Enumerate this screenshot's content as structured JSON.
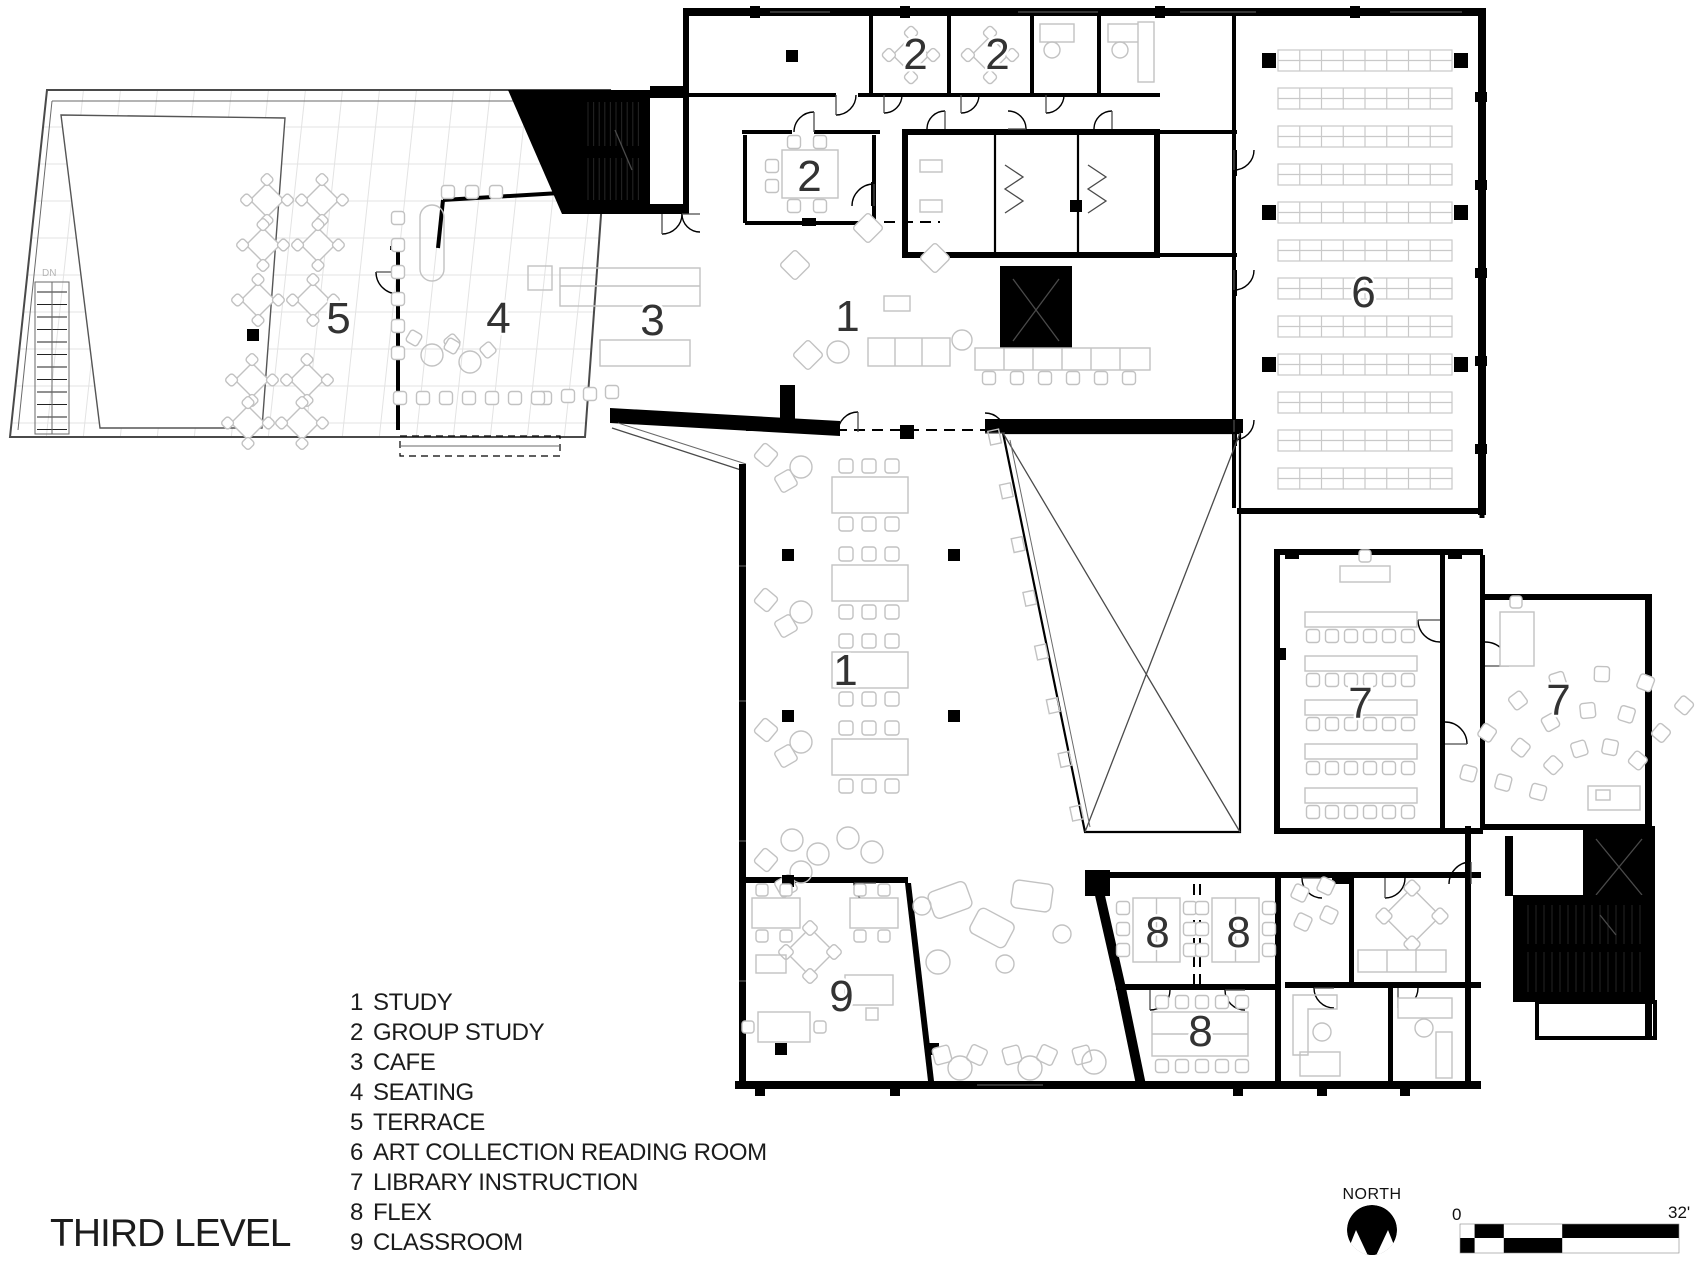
{
  "page": {
    "title": "THIRD LEVEL"
  },
  "legend": {
    "items": [
      {
        "number": "1",
        "label": "STUDY"
      },
      {
        "number": "2",
        "label": "GROUP STUDY"
      },
      {
        "number": "3",
        "label": "CAFE"
      },
      {
        "number": "4",
        "label": "SEATING"
      },
      {
        "number": "5",
        "label": "TERRACE"
      },
      {
        "number": "6",
        "label": "ART COLLECTION READING ROOM"
      },
      {
        "number": "7",
        "label": "LIBRARY INSTRUCTION"
      },
      {
        "number": "8",
        "label": "FLEX"
      },
      {
        "number": "9",
        "label": "CLASSROOM"
      }
    ]
  },
  "plan": {
    "stair_note": "DN",
    "room_labels": [
      {
        "id": "terrace",
        "text": "5",
        "x": 338,
        "y": 318
      },
      {
        "id": "seating",
        "text": "4",
        "x": 498,
        "y": 318
      },
      {
        "id": "cafe",
        "text": "3",
        "x": 652,
        "y": 320
      },
      {
        "id": "study-upper",
        "text": "1",
        "x": 847,
        "y": 316
      },
      {
        "id": "group-study-a",
        "text": "2",
        "x": 915,
        "y": 54
      },
      {
        "id": "group-study-b",
        "text": "2",
        "x": 997,
        "y": 54
      },
      {
        "id": "group-study-c",
        "text": "2",
        "x": 809,
        "y": 176
      },
      {
        "id": "art-collection",
        "text": "6",
        "x": 1363,
        "y": 292
      },
      {
        "id": "study-lower",
        "text": "1",
        "x": 845,
        "y": 670
      },
      {
        "id": "instruction-a",
        "text": "7",
        "x": 1360,
        "y": 703
      },
      {
        "id": "instruction-b",
        "text": "7",
        "x": 1558,
        "y": 700
      },
      {
        "id": "classroom",
        "text": "9",
        "x": 841,
        "y": 996
      },
      {
        "id": "flex-a",
        "text": "8",
        "x": 1157,
        "y": 932
      },
      {
        "id": "flex-b",
        "text": "8",
        "x": 1238,
        "y": 932
      },
      {
        "id": "flex-c",
        "text": "8",
        "x": 1200,
        "y": 1031
      }
    ]
  },
  "compass": {
    "label": "NORTH"
  },
  "scale_bar": {
    "zero_label": "0",
    "end_label": "32'"
  },
  "colors": {
    "wall": "#000000",
    "furniture": "#c2c2c2",
    "label": "#333333"
  }
}
